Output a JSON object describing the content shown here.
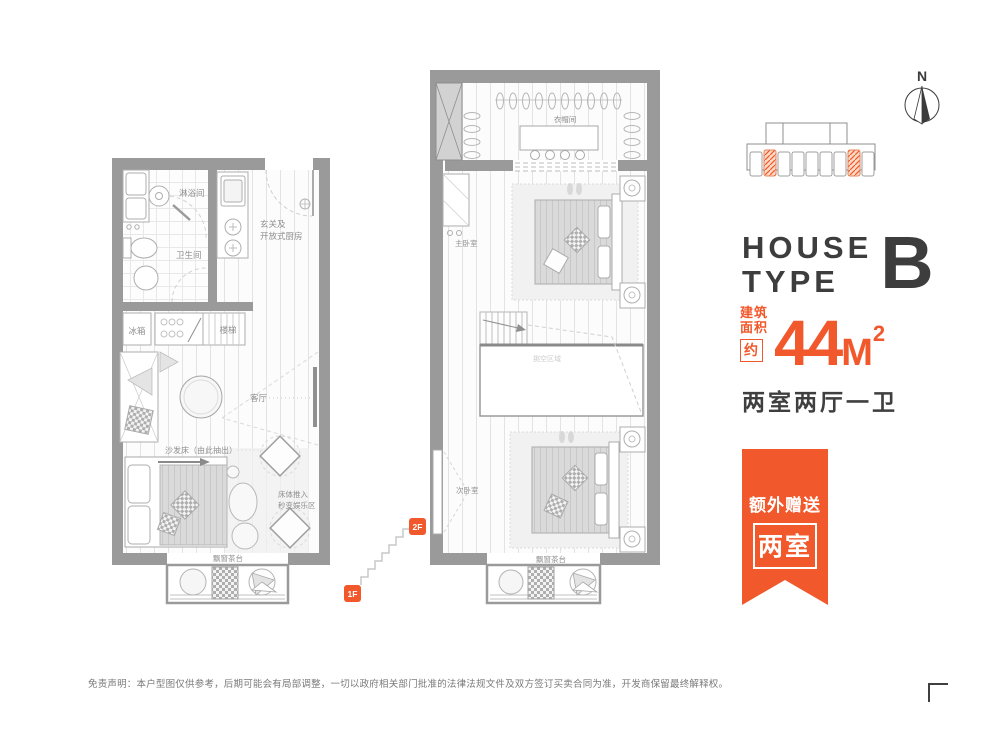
{
  "colors": {
    "accent": "#f1582b",
    "dark": "#3f3f3f",
    "wall": "#9a9a9a"
  },
  "right_panel": {
    "house_line1": "HOUSE",
    "house_line2": "TYPE",
    "type_letter": "B",
    "area_label_line1": "建筑",
    "area_label_line2": "面积",
    "area_approx": "约",
    "area_value": "44",
    "area_unit": "M",
    "area_sup": "2",
    "layout": "两室两厅一卫"
  },
  "ribbon": {
    "line1": "额外赠送",
    "line2": "两室"
  },
  "compass": {
    "north": "N"
  },
  "badges": {
    "f1": "1F",
    "f2": "2F"
  },
  "plan_1f": {
    "shower": "淋浴间",
    "toilet": "卫生间",
    "entry_line1": "玄关及",
    "entry_line2": "开放式厨房",
    "fridge": "冰箱",
    "stairs": "楼梯",
    "living": "客厅",
    "sofa_bed": "沙发床（由此抽出）",
    "bed_push_line1": "床体推入",
    "bed_push_line2": "秒变娱乐区",
    "bay_tea": "飘窗茶台"
  },
  "plan_2f": {
    "closet": "衣帽间",
    "master": "主卧室",
    "void_area": "挑空区域",
    "second": "次卧室",
    "bay_tea": "飘窗茶台"
  },
  "disclaimer": "免责声明：本户型图仅供参考，后期可能会有局部调整，一切以政府相关部门批准的法律法规文件及双方签订买卖合同为准，开发商保留最终解释权。"
}
